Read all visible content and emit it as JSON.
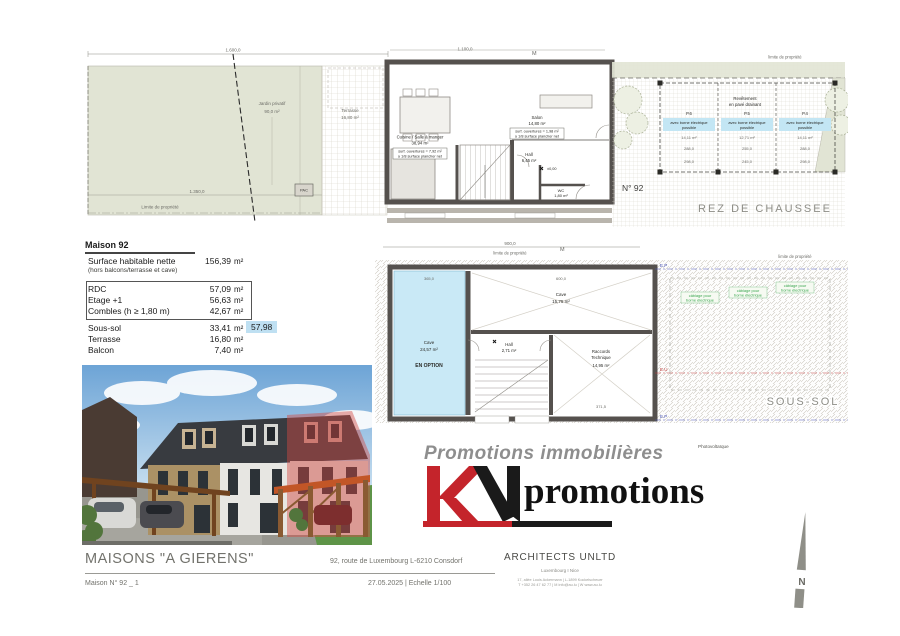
{
  "rdc": {
    "title": "REZ DE CHAUSSEE",
    "house_no": "N° 92",
    "dim_1600": "1.600,0",
    "dim_1350": "1.350,0",
    "dim_1100": "1.100,0",
    "marker_m": "M",
    "jardin_label": "Jardin privatif",
    "jardin_area": "90,0 m²",
    "limite_garden": "Limite de propriété",
    "limite_drive": "limite de propriété",
    "pac": "PAC",
    "terrasse_label": "Terrasse",
    "terrasse_area": "16,80 m²",
    "cuisine_name": "Cuisine / Salle à manger",
    "cuisine_area": "38,94 m²",
    "cuisine_note1": "surf. ouvertures = 7,92 m²",
    "cuisine_note2": "≥ 1/8 surface plancher net",
    "salon_name": "Salon",
    "salon_area": "14,80 m²",
    "salon_note1": "surf. ouvertures = 1,98 m²",
    "salon_note2": "≥ 1/8 surface plancher net",
    "hall_name": "Hall",
    "hall_area": "6,45 m²",
    "wc_name": "WC",
    "wc_area": "1,80 m²",
    "level": "±0,00",
    "revetement1": "Revêtement",
    "revetement2": "en pavé drainant",
    "parking_note1": "avec borne électrique",
    "parking_note2": "possible",
    "parking": [
      {
        "id": "P.6",
        "area": "14,11 m²",
        "dim1": "288,0",
        "dim2": "298,0"
      },
      {
        "id": "P.5",
        "area": "12,71 m²",
        "dim1": "255,0",
        "dim2": "245,0"
      },
      {
        "id": "P.4",
        "area": "14,11 m²",
        "dim1": "288,0",
        "dim2": "298,0"
      }
    ]
  },
  "table": {
    "title": "Maison 92",
    "net_label": "Surface habitable nette",
    "net_value": "156,39",
    "net_unit": "m²",
    "net_note": "(hors balcons/terrasse et cave)",
    "box_rows": [
      {
        "label": "RDC",
        "value": "57,09",
        "unit": "m²"
      },
      {
        "label": "Etage +1",
        "value": "56,63",
        "unit": "m²"
      },
      {
        "label": "Combles (h ≥ 1,80 m)",
        "value": "42,67",
        "unit": "m²"
      }
    ],
    "extra_rows": [
      {
        "label": "Sous-sol",
        "value": "33,41",
        "unit": "m²"
      },
      {
        "label": "Terrasse",
        "value": "16,80",
        "unit": "m²"
      },
      {
        "label": "Balcon",
        "value": "7,40",
        "unit": "m²"
      }
    ],
    "highlight_value": "57,98"
  },
  "soussol": {
    "title": "SOUS-SOL",
    "dim_900": "900,0",
    "dim_600": "600,0",
    "dim_365": "365,0",
    "dim_371": "371,5",
    "marker_m": "M",
    "limite_top": "limite de propriété",
    "limite_right": "limite de propriété",
    "cave1_name": "Cave",
    "cave1_area": "24,57 m²",
    "cave1_option": "EN OPTION",
    "cave2_name": "Cave",
    "cave2_area": "15,75 m²",
    "hall_name": "Hall",
    "hall_area": "2,71 m²",
    "tech_name1": "Raccords",
    "tech_name2": "Technique",
    "tech_area": "14,95 m²",
    "cable_line1": "câblage pour",
    "cable_line2": "borne électrique",
    "ep": "E.P",
    "eu": "E.U"
  },
  "logo": {
    "tagline": "Promotions immobilières",
    "brand": "promotions"
  },
  "photovoltaique": "Photovoltaïque",
  "compass": {
    "n": "N"
  },
  "footer": {
    "project_title": "MAISONS \"A GIERENS\"",
    "address": "92, route de Luxembourg L-6210 Consdorf",
    "plan_ref": "Maison N° 92 _ 1",
    "date_scale": "27.05.2025    |    Echelle 1/100",
    "firm": "ARCHITECTS UNLTD",
    "firm_sub": "Luxembourg I Nice",
    "firm_line1": "17, allée Louis Ackermann   |   L-1899 Kockelscheuer",
    "firm_line2": "T +352 26 47 62 77   |   M info@au.lu   |   W www.au.lu"
  },
  "colors": {
    "accent_red": "#c4242b",
    "highlight_blue": "#bfe0f2",
    "cave_blue": "#c9e9f6",
    "garden_green": "#e1e4d4",
    "cable_green": "#3aa64f"
  }
}
